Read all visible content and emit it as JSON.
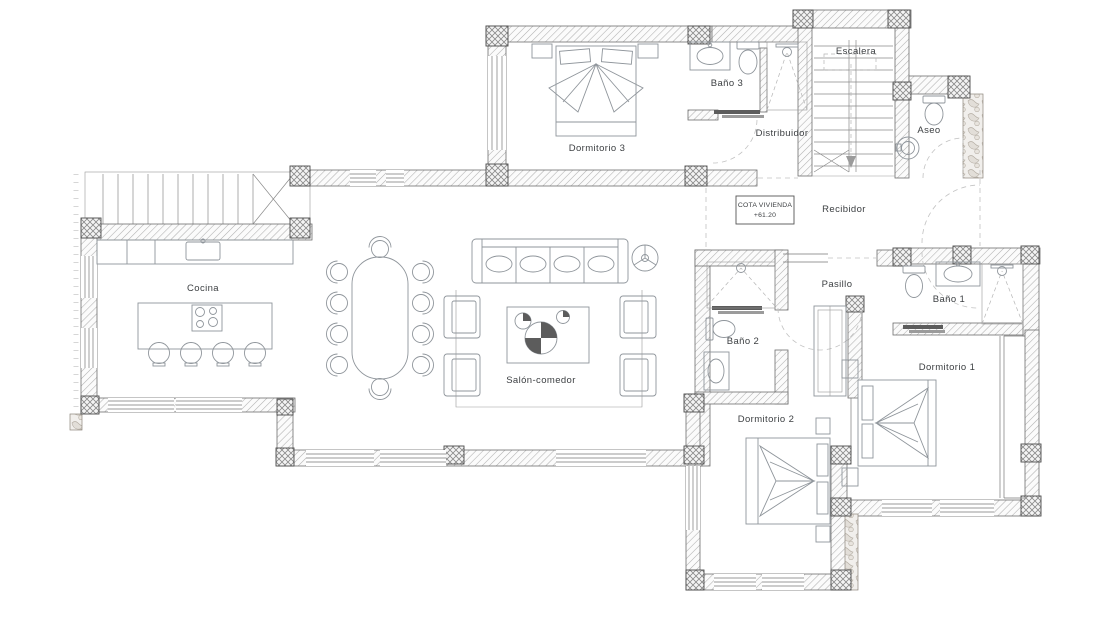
{
  "plan": {
    "rooms": {
      "cocina": {
        "label": "Cocina"
      },
      "salon_comedor": {
        "label": "Salón-comedor"
      },
      "dormitorio_1": {
        "label": "Dormitorio 1"
      },
      "dormitorio_2": {
        "label": "Dormitorio 2"
      },
      "dormitorio_3": {
        "label": "Dormitorio 3"
      },
      "bano_1": {
        "label": "Baño 1"
      },
      "bano_2": {
        "label": "Baño 2"
      },
      "bano_3": {
        "label": "Baño 3"
      },
      "aseo": {
        "label": "Aseo"
      },
      "escalera": {
        "label": "Escalera"
      },
      "distribuidor": {
        "label": "Distribuidor"
      },
      "recibidor": {
        "label": "Recibidor"
      },
      "pasillo": {
        "label": "Pasillo"
      }
    },
    "annotation": {
      "cota_line1": "COTA VIVIENDA",
      "cota_line2": "+61.20"
    },
    "colors": {
      "wall_line": "#6f6f6f",
      "hatch_line": "#b0b0b0",
      "furniture_line": "#8f959b",
      "label_text": "#3d4043"
    }
  }
}
